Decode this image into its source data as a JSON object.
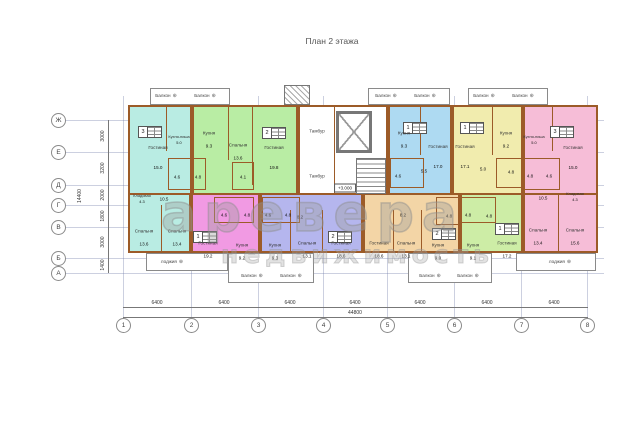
{
  "title": "План 2 этажа",
  "watermark": {
    "line1": "аревера",
    "line2": "недвижимость"
  },
  "core": {
    "tambour1": "Тамбур",
    "tambour2": "Тамбур",
    "level_mark": "+3.000"
  },
  "labels": {
    "balcony": "Балкон",
    "loggia": "лоджия",
    "balcony_mark": "⊕"
  },
  "axes": {
    "letters": [
      "Ж",
      "Е",
      "Д",
      "Г",
      "В",
      "Б",
      "А"
    ],
    "numbers": [
      "1",
      "2",
      "3",
      "4",
      "5",
      "6",
      "7",
      "8"
    ],
    "span_dims": [
      "6400",
      "6400",
      "6400",
      "6400",
      "6400",
      "6400",
      "6400"
    ],
    "total_dim": "44800",
    "left_dims": [
      "3000",
      "3200",
      "2000",
      "1800",
      "3000",
      "1400"
    ],
    "left_total": "14400"
  },
  "colors": {
    "teal": "#b9ece3",
    "green_top": "#b9eda4",
    "blue": "#aedaf2",
    "yellow": "#f1ecae",
    "pink": "#f6bdd7",
    "magenta": "#f19ae3",
    "periwinkle": "#b5b6ee",
    "tan": "#f3d5a6",
    "green_bottom": "#cdeda6",
    "wall": "#9c5b28"
  },
  "apartments": [
    {
      "id": "apt-3k-left",
      "stamp": "3",
      "rooms": [
        {
          "name": "Гостиная",
          "area": "15.0"
        },
        {
          "name": "Кухня-ниша",
          "area": "5.0"
        },
        {
          "name": "",
          "area": "4.6"
        },
        {
          "name": "",
          "area": "4.8"
        },
        {
          "name": "Кладовая",
          "area": "4.3"
        },
        {
          "name": "",
          "area": "10.5"
        },
        {
          "name": "Спальня",
          "area": "13.6"
        },
        {
          "name": "Спальня",
          "area": "13.4"
        }
      ]
    },
    {
      "id": "apt-2k-green-top",
      "stamp": "2",
      "rooms": [
        {
          "name": "Кухня",
          "area": "9.3"
        },
        {
          "name": "Спальня",
          "area": "13.6"
        },
        {
          "name": "Гостиная",
          "area": "19.8"
        },
        {
          "name": "",
          "area": "4.1"
        }
      ]
    },
    {
      "id": "apt-1k-blue",
      "stamp": "1",
      "rooms": [
        {
          "name": "Кухня",
          "area": "9.3"
        },
        {
          "name": "Гостиная",
          "area": "17.0"
        },
        {
          "name": "",
          "area": "5.5"
        },
        {
          "name": "",
          "area": "4.6"
        }
      ]
    },
    {
      "id": "apt-1k-yellow",
      "stamp": "1",
      "rooms": [
        {
          "name": "Гостиная",
          "area": "17.1"
        },
        {
          "name": "Кухня",
          "area": "9.2"
        },
        {
          "name": "",
          "area": "5.0"
        },
        {
          "name": "",
          "area": "4.8"
        }
      ]
    },
    {
      "id": "apt-3k-pink-right",
      "stamp": "3",
      "rooms": [
        {
          "name": "Кухня-ниша",
          "area": "5.0"
        },
        {
          "name": "Гостиная",
          "area": "15.0"
        },
        {
          "name": "",
          "area": "4.8"
        },
        {
          "name": "",
          "area": "4.6"
        },
        {
          "name": "Кладовая",
          "area": "4.3"
        },
        {
          "name": "",
          "area": "10.5"
        },
        {
          "name": "Спальня",
          "area": "13.4"
        },
        {
          "name": "Спальня",
          "area": "15.6"
        }
      ]
    },
    {
      "id": "apt-1k-magenta",
      "stamp": "1",
      "rooms": [
        {
          "name": "Гостиная",
          "area": "19.2"
        },
        {
          "name": "Кухня",
          "area": "9.2"
        },
        {
          "name": "",
          "area": "4.6"
        },
        {
          "name": "",
          "area": "4.8"
        }
      ]
    },
    {
      "id": "apt-2k-periwinkle",
      "stamp": "2",
      "rooms": [
        {
          "name": "Кухня",
          "area": "9.3"
        },
        {
          "name": "Спальня",
          "area": "13.1"
        },
        {
          "name": "Гостиная",
          "area": "18.6"
        },
        {
          "name": "",
          "area": "4.6"
        },
        {
          "name": "",
          "area": "4.8"
        },
        {
          "name": "",
          "area": "8.2"
        }
      ]
    },
    {
      "id": "apt-2k-tan",
      "stamp": "2",
      "rooms": [
        {
          "name": "Гостиная",
          "area": "18.6"
        },
        {
          "name": "Спальня",
          "area": "13.1"
        },
        {
          "name": "Кухня",
          "area": "9.0"
        },
        {
          "name": "",
          "area": "8.2"
        },
        {
          "name": "",
          "area": "4.8"
        }
      ]
    },
    {
      "id": "apt-1k-green-bottom",
      "stamp": "1",
      "rooms": [
        {
          "name": "Кухня",
          "area": "9.1"
        },
        {
          "name": "Гостиная",
          "area": "17.2"
        },
        {
          "name": "",
          "area": "4.8"
        },
        {
          "name": "",
          "area": "4.8"
        }
      ]
    }
  ]
}
